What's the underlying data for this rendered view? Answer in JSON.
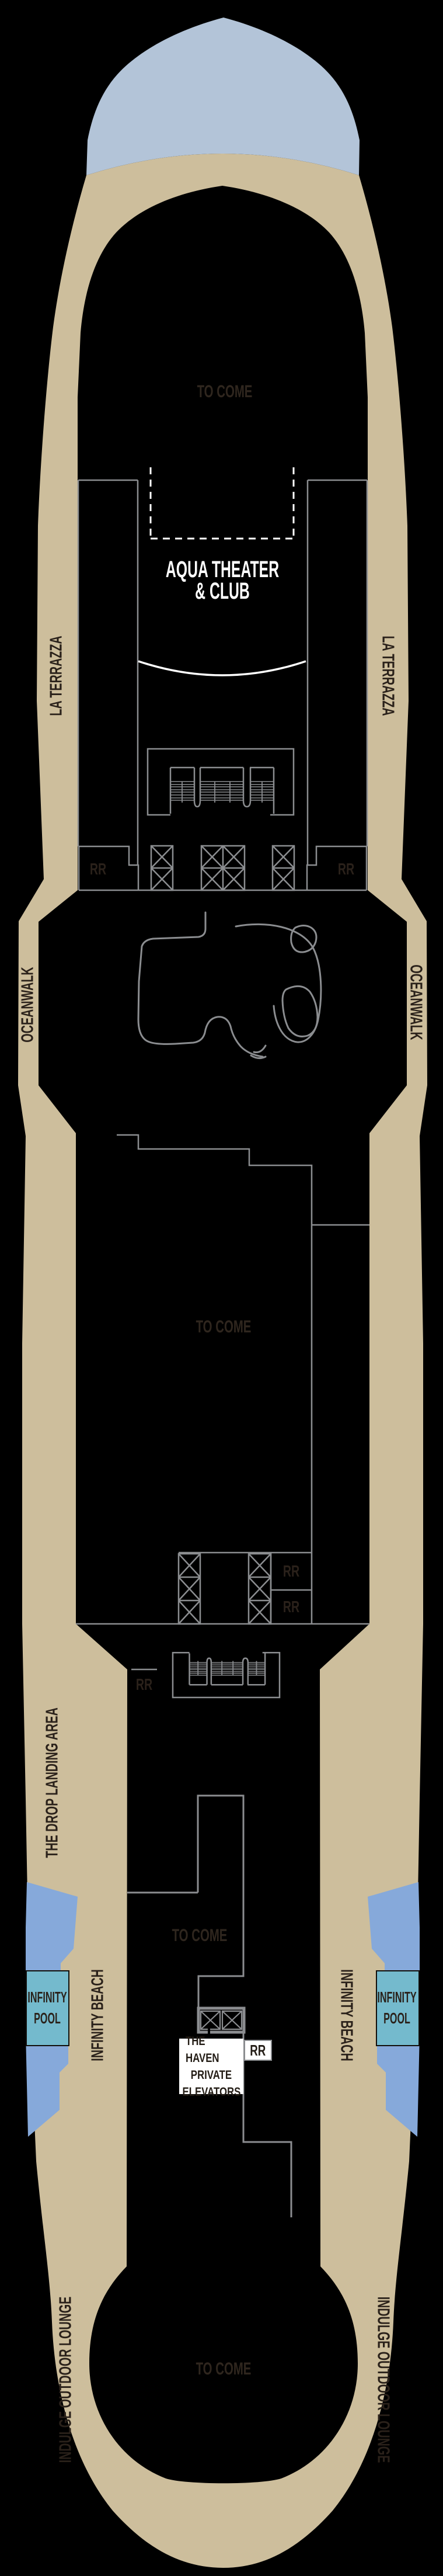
{
  "page": {
    "title": "Cruise ship deck plan",
    "kind": "deck-plan"
  },
  "colors": {
    "background": "#000000",
    "deck_tan": "#cdbe9c",
    "bow_cap_blue": "#b3c4d8",
    "water_blue": "#86a9da",
    "pool_teal": "#74bacd",
    "line_gray": "#8b8d90",
    "label_dark": "#2a211a",
    "placeholder_dark": "#2f261e",
    "label_white": "#ffffff"
  },
  "labels": {
    "to_come": "TO COME",
    "aqua_theater": {
      "line1": "AQUA THEATER",
      "line2": "& CLUB"
    },
    "la_terrazza": "LA TERRAZZA",
    "oceanwalk": "OCEANWALK",
    "drop_landing_area": "THE DROP LANDING AREA",
    "infinity_beach": "INFINITY BEACH",
    "infinity_pool": {
      "line1": "INFINITY",
      "line2": "POOL"
    },
    "indulge_outdoor_lounge": "INDULGE OUTDOOR LOUNGE",
    "haven_elevators": {
      "line1": "THE HAVEN",
      "line2": "PRIVATE",
      "line3": "ELEVATORS"
    },
    "restroom": "RR"
  }
}
